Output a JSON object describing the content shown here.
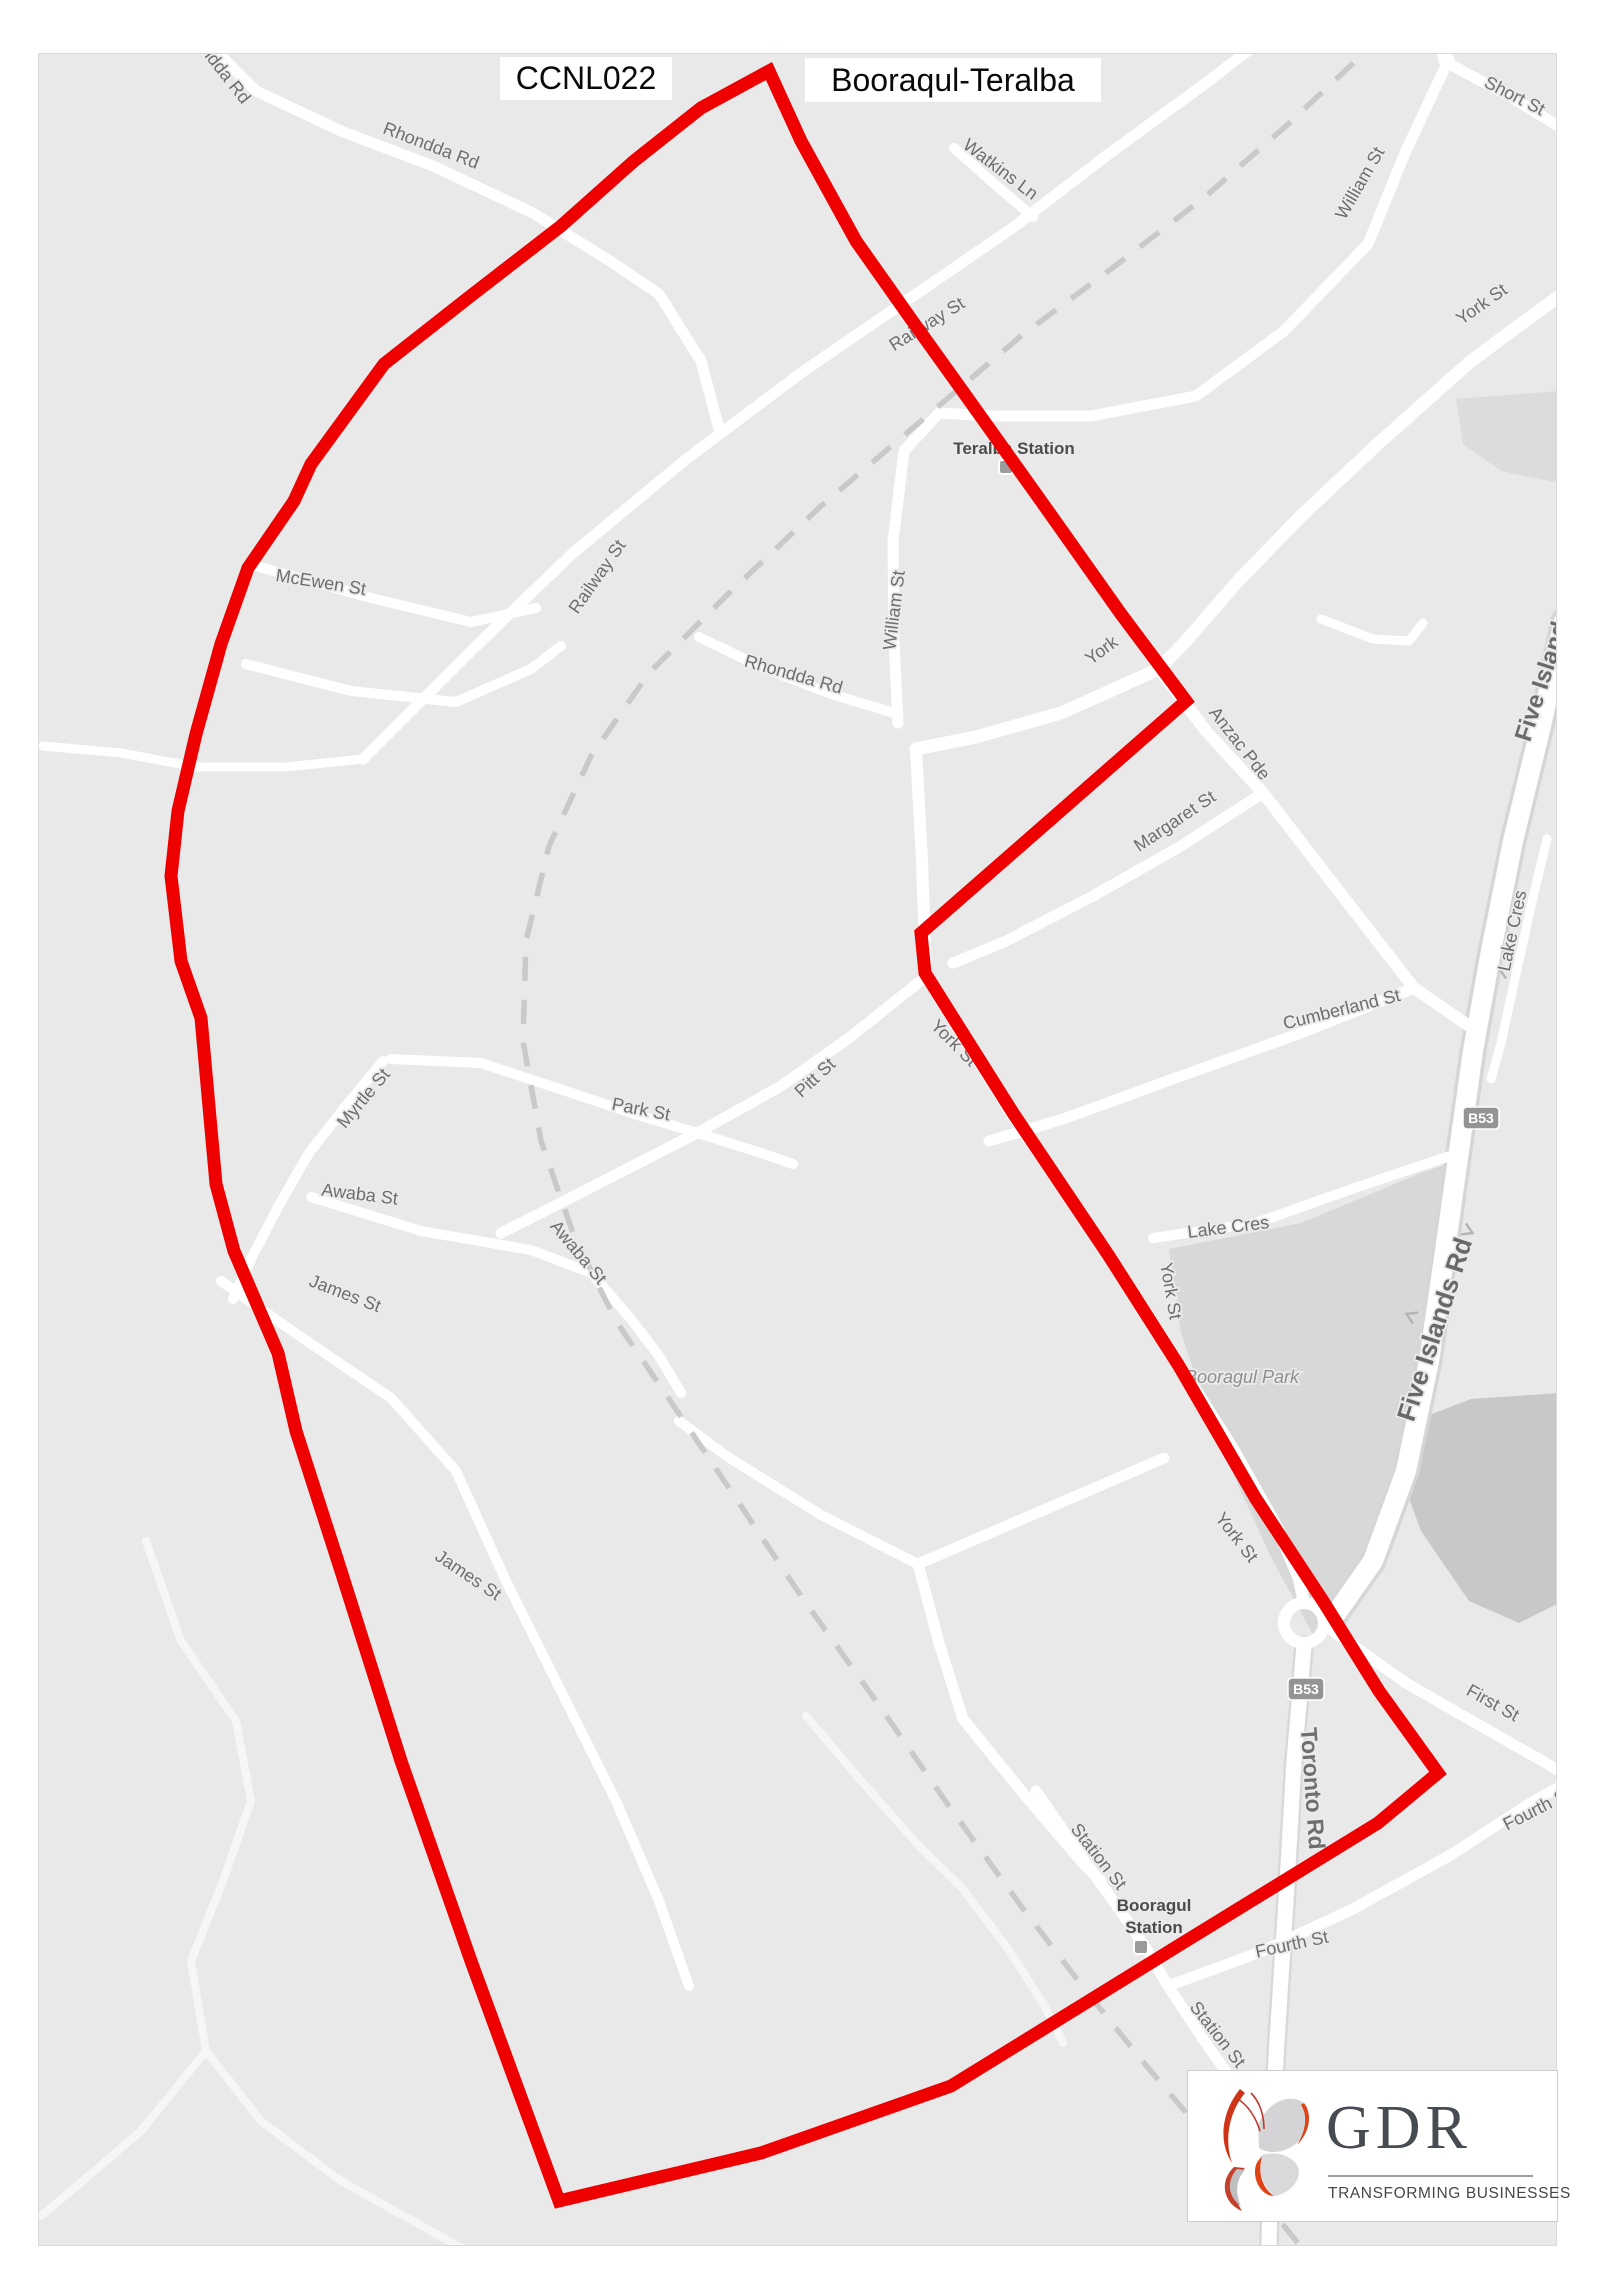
{
  "title": {
    "code": "CCNL022",
    "name": "Booraqul-Teralba"
  },
  "logo": {
    "text": "GDR",
    "tagline": "TRANSFORMING BUSINESSES",
    "accent_red": "#d23a17",
    "text_color": "#474c52"
  },
  "map": {
    "background": "#e9e9e9",
    "road_color": "#ffffff",
    "label_color": "#6e6e6e",
    "railway_color": "#c9c9c9",
    "boundary_color": "#ee0000",
    "boundary_points": "768,70 800,140 855,240 910,318 958,385 1040,500 1120,613 1185,700 1048,820 920,932 924,972 1012,1112 1108,1255 1178,1365 1255,1498 1322,1600 1378,1690 1437,1772 1377,1822 1180,1943 950,2085 760,2152 558,2200 470,1960 400,1760 340,1570 295,1430 277,1352 233,1250 215,1183 200,1017 180,960 170,875 177,810 195,733 220,643 247,567 293,500 310,463 383,363 467,297 560,225 633,160 700,107",
    "railway_path": "1412,0 1360,55 1285,125 1205,195 1118,262 1020,335 920,420 820,505 725,595 648,672 590,755 548,845 525,940 522,1040 540,1140 573,1235 615,1320 668,1398 730,1490 800,1595 875,1700 950,1808 1020,1905 1085,1990 1148,2068 1205,2135 1255,2190 1300,2246",
    "areas": [
      {
        "n": "booragul-park",
        "f": "#d8d8d8",
        "p": "1168,1248 1300,1222 1420,1172 1446,1163 1432,1310 1400,1460 1352,1588 1318,1645 1270,1556 1216,1438 1180,1332"
      },
      {
        "n": "terrain-dark",
        "f": "#c8c8c8",
        "p": "1413,1420 1470,1398 1558,1392 1558,1602 1518,1622 1468,1600 1420,1530 1398,1470"
      },
      {
        "n": "top-right-patch",
        "f": "#dcdcdc",
        "p": "1455,398 1558,390 1558,482 1500,470 1462,443"
      }
    ],
    "roads": [
      {
        "n": "rhondda-rd-top",
        "w": 11,
        "p": "190,25 255,90 340,130 432,165 532,212 612,262 658,293 700,360 718,428"
      },
      {
        "n": "west-connector",
        "w": 9,
        "p": "42,745 120,752 195,766 285,766 362,758"
      },
      {
        "n": "railway-st",
        "w": 11,
        "p": "362,758 470,650 572,552 688,456 800,372 905,300 1010,228 1105,155 1205,82 1262,38 1300,0"
      },
      {
        "n": "watkins-ln",
        "w": 10,
        "p": "1032,216 990,180 953,147"
      },
      {
        "n": "short-st",
        "w": 11,
        "p": "1443,60 1510,96 1557,125"
      },
      {
        "n": "short-st-n",
        "w": 10,
        "p": "1443,60 1427,10 1424,0"
      },
      {
        "n": "william-st",
        "w": 11,
        "p": "1448,58 1404,152 1367,243 1283,330 1195,395 1090,415 995,415 938,412 903,450 892,540 893,640 897,722"
      },
      {
        "n": "york-anzac-ave",
        "w": 13,
        "p": "1565,290 1470,360 1380,440 1300,515 1237,580 1185,640 1158,668 1060,712 975,736 915,748"
      },
      {
        "n": "anzac-pde",
        "w": 12,
        "p": "1158,668 1205,730 1262,792 1340,893 1413,987 1468,1025"
      },
      {
        "n": "hook-stub",
        "w": 9,
        "p": "1320,618 1372,638 1408,640 1422,622"
      },
      {
        "n": "margaret-st",
        "w": 11,
        "p": "1262,792 1180,845 1092,895 1005,940 952,962"
      },
      {
        "n": "cumberland-st",
        "w": 11,
        "p": "1413,987 1300,1032 1180,1075 1062,1118 988,1140"
      },
      {
        "n": "rhondda-rd-s",
        "w": 10,
        "p": "698,636 760,666 830,693 893,712"
      },
      {
        "n": "mcewen-st",
        "w": 10,
        "p": "255,565 370,597 470,621 535,607"
      },
      {
        "n": "mcewen-lower",
        "w": 10,
        "p": "245,663 350,690 455,701 530,668 560,645"
      },
      {
        "n": "york-st-south",
        "w": 12,
        "p": "915,748 921,860 925,975 1012,1115 1107,1252 1170,1350 1232,1448 1277,1528 1298,1578 1303,1602"
      },
      {
        "n": "toronto-rd",
        "w": 15,
        "cw": 20,
        "cc": "#d9d9d9",
        "p": "1303,1645 1293,1760 1285,1900 1276,2040 1270,2150 1268,2246"
      },
      {
        "n": "five-islands-rd",
        "w": 20,
        "cw": 27,
        "cc": "#d6d6d6",
        "p": "1563,620 1540,725 1512,840 1490,950 1472,1050 1458,1150 1444,1250 1428,1360 1405,1470 1372,1560 1330,1620"
      },
      {
        "n": "lake-cres-n",
        "w": 9,
        "p": "1546,838 1530,905 1514,978 1500,1042 1490,1078"
      },
      {
        "n": "lake-cres-s",
        "w": 10,
        "p": "1152,1237 1255,1222 1345,1190 1425,1163 1452,1154"
      },
      {
        "n": "first-st",
        "w": 11,
        "p": "1332,1630 1405,1682 1480,1725 1545,1762 1562,1772"
      },
      {
        "n": "fourth-st",
        "w": 11,
        "p": "1167,1985 1262,1950 1352,1908 1448,1855 1533,1800 1565,1782"
      },
      {
        "n": "station-st",
        "w": 11,
        "p": "1035,1790 1078,1852 1125,1918 1148,1952 1167,1985 1200,2035 1235,2085 1262,2125"
      },
      {
        "n": "block-road",
        "w": 11,
        "p": "1163,1457 1110,1480 1010,1523 917,1563 938,1642 962,1718 1022,1792 1080,1860 1100,1880"
      },
      {
        "n": "block-spur",
        "w": 10,
        "p": "917,1563 820,1514 727,1456 678,1420"
      },
      {
        "n": "pitt-st",
        "w": 11,
        "p": "922,978 848,1037 780,1085 700,1130 618,1172 540,1212 500,1232"
      },
      {
        "n": "park-st",
        "w": 10,
        "p": "390,1058 480,1062 556,1087 640,1115 700,1133 760,1152 792,1163"
      },
      {
        "n": "myrtle-st",
        "w": 10,
        "p": "382,1060 344,1106 308,1152 277,1206 250,1258 232,1298"
      },
      {
        "n": "awaba-st",
        "w": 10,
        "p": "310,1196 420,1230 530,1249 590,1272 630,1318 658,1355 680,1392"
      },
      {
        "n": "james-st",
        "w": 10,
        "p": "220,1280 300,1336 390,1397 455,1470 505,1580 560,1690 615,1800 658,1900 688,1985"
      },
      {
        "n": "sw-track-1",
        "w": 8,
        "c": "#f6f6f6",
        "p": "145,1540 180,1640 235,1720 250,1800 222,1880 190,1960 205,2050 260,2120 340,2180 430,2230 470,2252"
      },
      {
        "n": "sw-track-2",
        "w": 8,
        "c": "#f6f6f6",
        "p": "205,2050 140,2130 70,2190 40,2215"
      },
      {
        "n": "sw-track-3",
        "w": 8,
        "c": "#f6f6f6",
        "p": "805,1715 862,1782 918,1845 962,1888 1005,1945 1042,2002 1062,2042"
      }
    ],
    "roundabout": {
      "x": 1303,
      "y": 1622,
      "r": 20,
      "w": 12
    },
    "labels": [
      {
        "t": "Rhondda Rd",
        "x": 210,
        "y": 64,
        "r": 52
      },
      {
        "t": "Rhondda Rd",
        "x": 428,
        "y": 150,
        "r": 21
      },
      {
        "t": "Watkins Ln",
        "x": 996,
        "y": 173,
        "r": 37
      },
      {
        "t": "Short St",
        "x": 1511,
        "y": 100,
        "r": 27
      },
      {
        "t": "William St",
        "x": 1364,
        "y": 185,
        "r": -60
      },
      {
        "t": "York St",
        "x": 1484,
        "y": 308,
        "r": -35
      },
      {
        "t": "Railway St",
        "x": 929,
        "y": 328,
        "r": -32
      },
      {
        "t": "Teralba Station",
        "x": 1013,
        "y": 453,
        "r": 0,
        "s": 17,
        "c": "#4c4c4c",
        "w": 600
      },
      {
        "t": "McEwen St",
        "x": 319,
        "y": 587,
        "r": 9
      },
      {
        "t": "Railway St",
        "x": 601,
        "y": 579,
        "r": -55
      },
      {
        "t": "William St",
        "x": 899,
        "y": 610,
        "r": -83
      },
      {
        "t": "Rhondda Rd",
        "x": 791,
        "y": 679,
        "r": 16
      },
      {
        "t": "York",
        "x": 1104,
        "y": 654,
        "r": -36
      },
      {
        "t": "Anzac Pde",
        "x": 1234,
        "y": 746,
        "r": 52
      },
      {
        "t": "Margaret St",
        "x": 1177,
        "y": 825,
        "r": -34
      },
      {
        "t": "Lake Cres",
        "x": 1517,
        "y": 931,
        "r": -78
      },
      {
        "t": "Cumberland St",
        "x": 1342,
        "y": 1014,
        "r": -14
      },
      {
        "t": "Five Islands Rd",
        "x": 1556,
        "y": 658,
        "r": -72,
        "s": 24,
        "c": "#6a6a6a",
        "w": 600
      },
      {
        "t": "Park St",
        "x": 639,
        "y": 1114,
        "r": 11
      },
      {
        "t": "Pitt St",
        "x": 818,
        "y": 1081,
        "r": -43
      },
      {
        "t": "York St",
        "x": 949,
        "y": 1046,
        "r": 45
      },
      {
        "t": "Myrtle St",
        "x": 367,
        "y": 1101,
        "r": -50
      },
      {
        "t": "Awaba St",
        "x": 358,
        "y": 1199,
        "r": 7
      },
      {
        "t": "Awaba St",
        "x": 573,
        "y": 1255,
        "r": 50
      },
      {
        "t": "Lake Cres",
        "x": 1228,
        "y": 1232,
        "r": -7
      },
      {
        "t": "York St",
        "x": 1164,
        "y": 1291,
        "r": 80
      },
      {
        "t": "James St",
        "x": 342,
        "y": 1298,
        "r": 21
      },
      {
        "t": "Five Islands Rd",
        "x": 1442,
        "y": 1331,
        "r": -72,
        "s": 26,
        "c": "#696969",
        "w": 600
      },
      {
        "t": "Booragul Park",
        "x": 1241,
        "y": 1382,
        "r": 0,
        "s": 18,
        "c": "#8f8f8f",
        "i": 1
      },
      {
        "t": "James St",
        "x": 464,
        "y": 1579,
        "r": 34
      },
      {
        "t": "York St",
        "x": 1231,
        "y": 1540,
        "r": 52
      },
      {
        "t": "First St",
        "x": 1489,
        "y": 1707,
        "r": 29
      },
      {
        "t": "Toronto Rd",
        "x": 1304,
        "y": 1788,
        "r": 86,
        "s": 23,
        "c": "#6f6f6f",
        "w": 600
      },
      {
        "t": "Fourth St",
        "x": 1539,
        "y": 1813,
        "r": -27
      },
      {
        "t": "Station St",
        "x": 1093,
        "y": 1859,
        "r": 52
      },
      {
        "t": "Booragul",
        "x": 1153,
        "y": 1910,
        "r": 0,
        "s": 17,
        "c": "#4c4c4c",
        "w": 600
      },
      {
        "t": "Station",
        "x": 1153,
        "y": 1932,
        "r": 0,
        "s": 17,
        "c": "#4c4c4c",
        "w": 600
      },
      {
        "t": "Fourth St",
        "x": 1292,
        "y": 1949,
        "r": -12
      },
      {
        "t": "Station St",
        "x": 1212,
        "y": 2037,
        "r": 52
      }
    ],
    "shields": [
      {
        "t": "B53",
        "x": 1480,
        "y": 1117
      },
      {
        "t": "B53",
        "x": 1305,
        "y": 1688
      }
    ],
    "stations": [
      {
        "x": 1005,
        "y": 466
      },
      {
        "x": 1140,
        "y": 1946
      }
    ],
    "arrows": [
      {
        "x": 1503,
        "y": 970,
        "r": -65
      },
      {
        "x": 1467,
        "y": 1230,
        "r": 115
      },
      {
        "x": 1410,
        "y": 1315,
        "r": -65
      }
    ]
  }
}
